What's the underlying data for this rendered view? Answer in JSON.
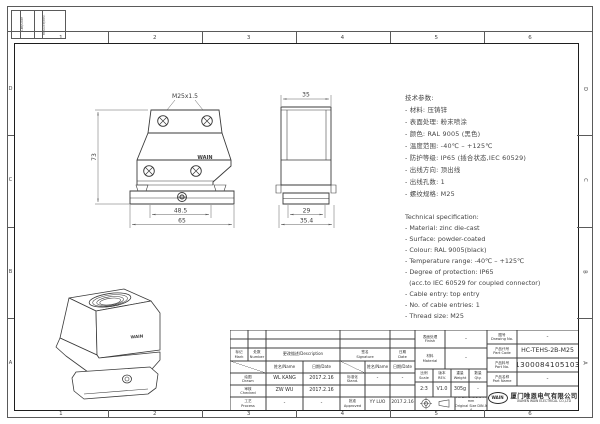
{
  "sheet": {
    "zones_top": [
      "1",
      "2",
      "3",
      "4",
      "5",
      "6"
    ],
    "zones_bottom": [
      "1",
      "2",
      "3",
      "4",
      "5",
      "6"
    ],
    "zones_left": [
      "D",
      "C",
      "B",
      "A"
    ],
    "zones_right": [
      "D",
      "C",
      "B",
      "A"
    ],
    "corner_strip": {
      "col1": "日期/Date",
      "col2": "更改记录/Rev."
    }
  },
  "views": {
    "front": {
      "thread": "M25x1.5",
      "height": "73",
      "width_inner": "48.5",
      "width_outer": "65",
      "brand": "WAIN"
    },
    "side": {
      "width_top": "35",
      "width_inner": "29",
      "width_outer": "35.4"
    },
    "iso": {
      "brand": "WAIN"
    }
  },
  "specs_cn": {
    "lines": [
      "技术参数:",
      "- 材料: 压铸锌",
      "- 表面处理: 粉末喷涂",
      "- 颜色: RAL 9005 (黑色)",
      "- 温度范围: -40℃ – +125℃",
      "- 防护等级: IP65 (插合状态,IEC 60529)",
      "- 出线方向: 顶出线",
      "- 出线孔数: 1",
      "- 螺纹规格: M25"
    ]
  },
  "specs_en": {
    "lines": [
      "Technical specification:",
      "- Material: zinc die-cast",
      "- Surface: powder-coated",
      "- Colour: RAL 9005(black)",
      "- Temperature range: -40℃ – +125℃",
      "- Degree of protection: IP65",
      "  (acc.to IEC 60529 for coupled connector)",
      "- Cable entry: top entry",
      "- No. of cable entries: 1",
      "- Thread size: M25"
    ]
  },
  "title_block": {
    "rev_table": {
      "mark_cn": "标记",
      "mark_en": "Mark",
      "number_cn": "处数",
      "number_en": "Number",
      "description": "更改描述/Description",
      "signature_cn": "签名",
      "signature_en": "Signature",
      "date_cn": "日期",
      "date_en": "Date",
      "name_header": "姓名/Name",
      "date_header": "日期/Date"
    },
    "approvals": {
      "drawn_cn": "绘图",
      "drawn_en": "Drawn",
      "drawn_name": "WL KANG",
      "drawn_date": "2017.2.16",
      "checked_cn": "审核",
      "checked_en": "Checked",
      "checked_name": "ZW WU",
      "checked_date": "2017.2.16",
      "process_cn": "工艺",
      "process_en": "Process",
      "process_name": "-",
      "process_date": "-",
      "stand_cn": "标准化",
      "stand_en": "Stand.",
      "stand_name": "-",
      "stand_date": "-",
      "approved_cn": "批准",
      "approved_en": "Approved",
      "approved_name": "YY LUO",
      "approved_date": "2017.2.16"
    },
    "fields": {
      "finish_cn": "表面处理",
      "finish_en": "Finish",
      "finish_value": "-",
      "material_cn": "材料",
      "material_en": "Material",
      "material_value": "-",
      "scale_cn": "比例",
      "scale_en": "Scale",
      "scale_value": "2:3",
      "rev_cn": "版本",
      "rev_en": "REV.",
      "rev_value": "V1.0",
      "weight_cn": "重量",
      "weight_en": "Weight",
      "weight_value": "305g",
      "qty_cn": "数量",
      "qty_en": "Qty.",
      "qty_value": "-",
      "drawing_no_cn": "图号",
      "drawing_no_en": "Drawing No.",
      "drawing_no_value": "-",
      "part_code_cn": "产品代号",
      "part_code_en": "Part Code",
      "part_code_value": "HC-TEHS-2B-M25",
      "part_no_cn": "产品料号",
      "part_no_en": "Part No.",
      "part_no_value": "1300084105103",
      "part_name_cn": "产品名称",
      "part_name_en": "Part Name",
      "part_name_value": "-"
    },
    "notes": {
      "line1": "All Dimensions in mm",
      "line2": "Original Size DIN A 4"
    },
    "company": {
      "logo": "WAIN",
      "cn": "厦门唯恩电气有限公司",
      "en": "XIAMEN WAIN ELECTRICAL CO.,LTD"
    }
  }
}
